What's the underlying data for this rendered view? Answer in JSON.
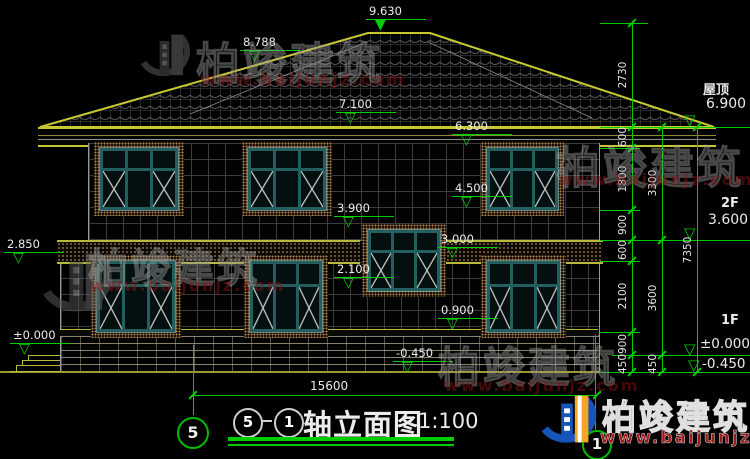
{
  "watermark": {
    "brand": "柏竣建筑",
    "url": "www.baijunjz.com"
  },
  "title": {
    "axis_left": "5",
    "axis_right": "1",
    "text": "轴立面图",
    "scale": "1:100"
  },
  "levels": {
    "ridge": "9.630",
    "roof_break": "8.788",
    "eave": "7.100",
    "win2f_head": "6.300",
    "win2f_sill": "4.500",
    "stair_head": "3.900",
    "stair_sill": "2.100",
    "win1f_head": "3.000",
    "win1f_sill": "0.900",
    "terrace": "2.850",
    "zero_left": "±0.000",
    "basement": "-0.450"
  },
  "right_annotations": {
    "roof_label": "屋顶",
    "roof_level": "6.900",
    "f2_label": "2F",
    "f2_level": "3.600",
    "f1_label": "1F",
    "f1_level": "±0.000",
    "ground_level": "-0.450"
  },
  "dimensions": {
    "chain_inner": [
      "2730",
      "600",
      "1800",
      "900",
      "600",
      "2100",
      "900",
      "450"
    ],
    "chain_middle": [
      "3300",
      "3600",
      "450"
    ],
    "chain_outer": [
      "7350"
    ],
    "total_width": "15600"
  },
  "axes": {
    "left_bubble": "5",
    "right_bubble": "1"
  },
  "icons": {
    "marker_open": "▽",
    "marker_filled": "▼"
  }
}
